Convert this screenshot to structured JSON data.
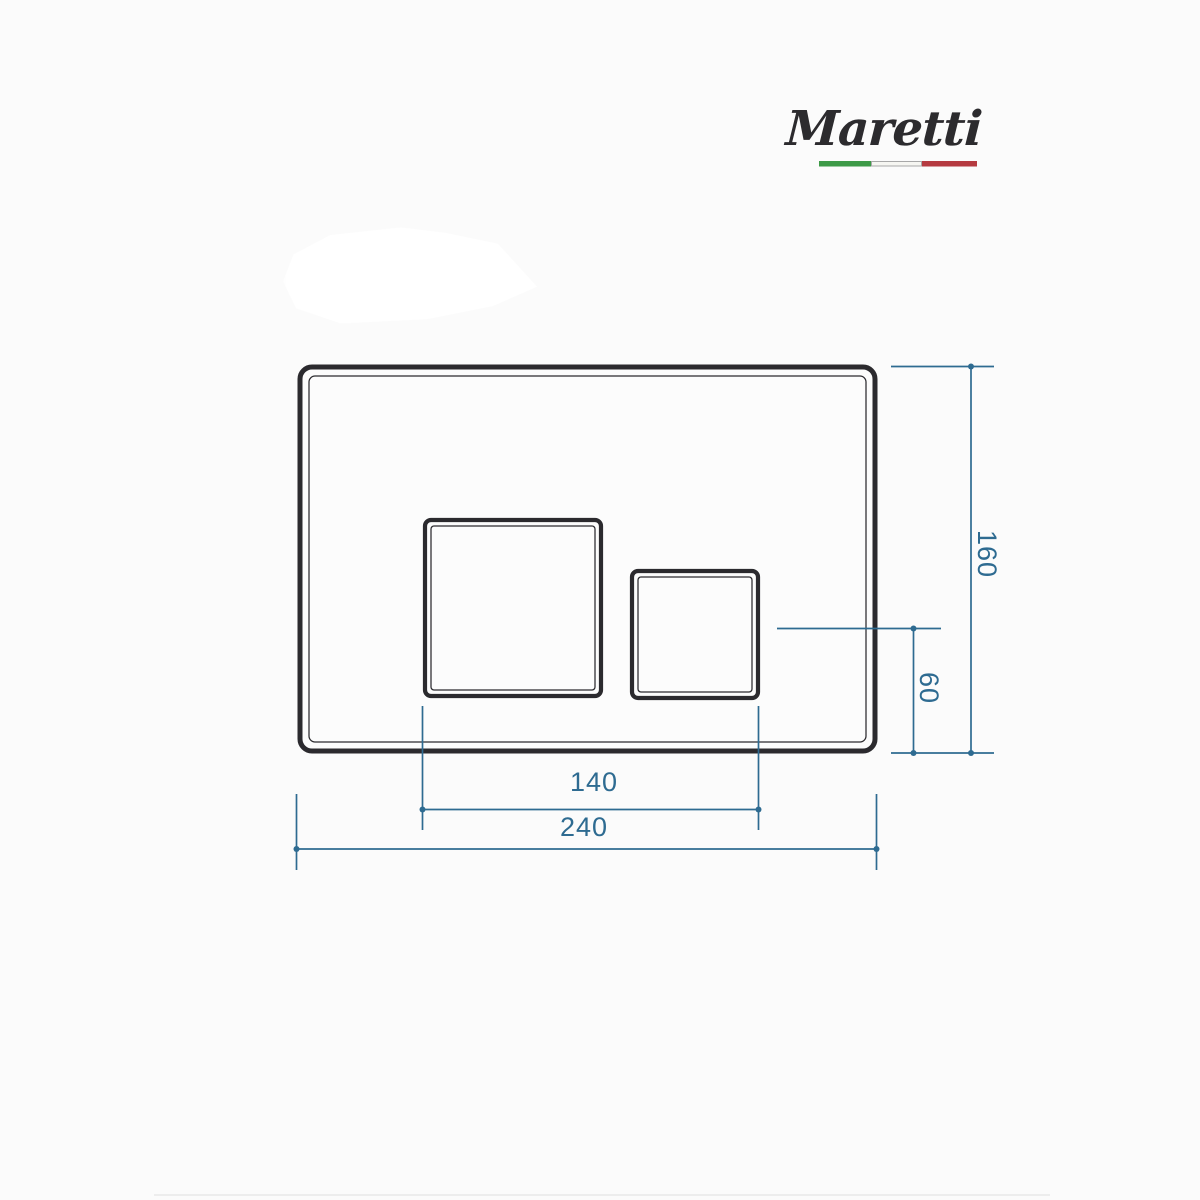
{
  "page": {
    "background_color": "#fbfbfb"
  },
  "logo": {
    "text": "Maretti",
    "text_color": "#2c2b2e",
    "flag": {
      "green": "#3d9a47",
      "white": "#f6f6f2",
      "white_border": "#a8a8a8",
      "red": "#b53a40"
    }
  },
  "drawing": {
    "description": "Front-view technical drawing of a rectangular toilet flush plate with one large and one small square button, with dimension lines",
    "outline_color": "#2b2a2e",
    "dimension_color": "#2e6b91",
    "dimensions": {
      "overall_width": "240",
      "overall_height": "160",
      "buttons_span": "140",
      "button_bottom_offset": "60"
    }
  }
}
